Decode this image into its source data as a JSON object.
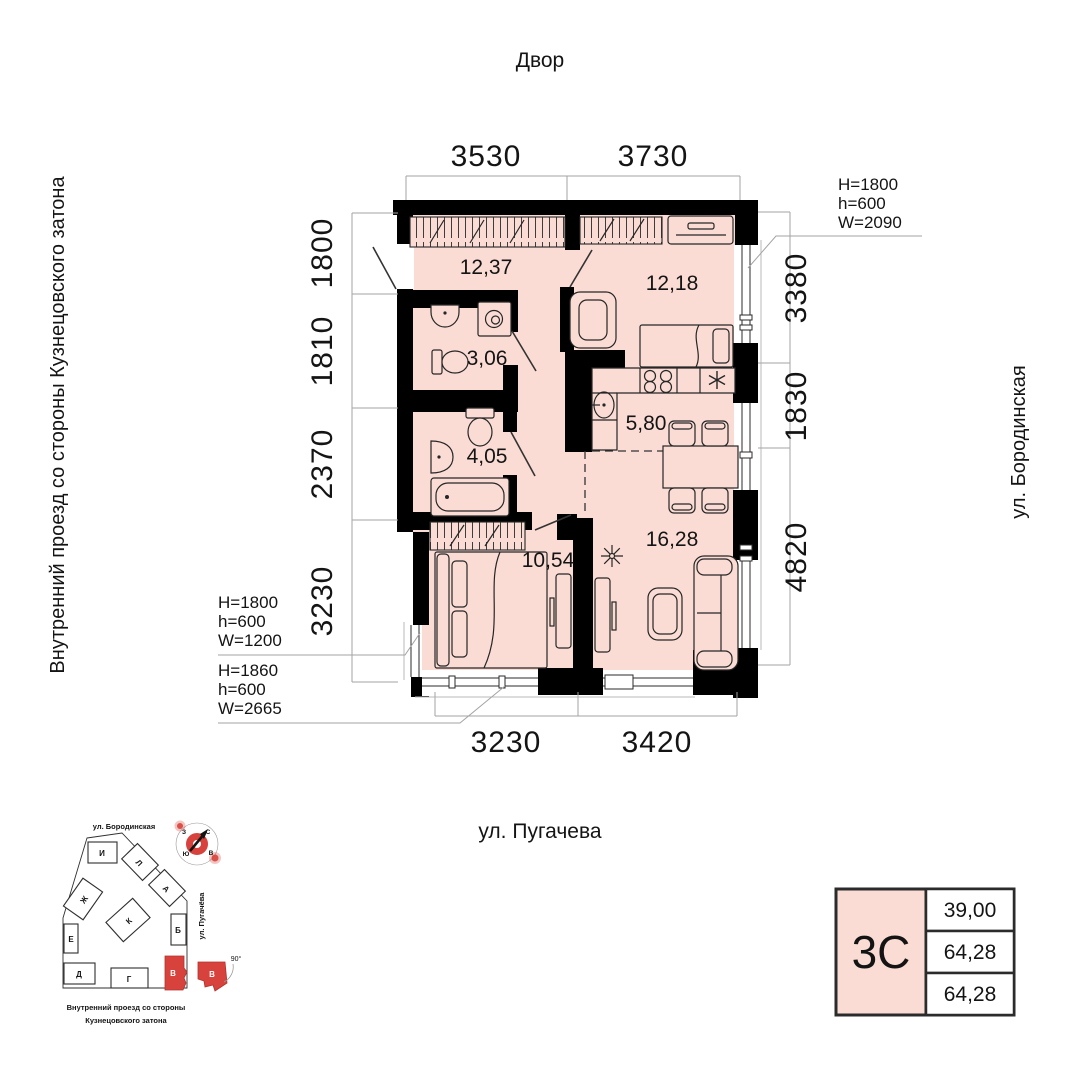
{
  "colors": {
    "room_fill": "#fadcd4",
    "wall": "#000000",
    "accent_red": "#d8423c",
    "dim_gray": "#a3a3a3",
    "text": "#141414"
  },
  "surroundings": {
    "top": "Двор",
    "bottom": "ул. Пугачева",
    "left": "Внутренний проезд со стороны Кузнецовского затона",
    "right": "ул. Бородинская"
  },
  "plan": {
    "rooms": [
      {
        "id": "hallway",
        "area": "12,37"
      },
      {
        "id": "bedroom-2",
        "area": "12,18"
      },
      {
        "id": "bathroom-small",
        "area": "3,06"
      },
      {
        "id": "bathroom-large",
        "area": "4,05"
      },
      {
        "id": "kitchen",
        "area": "5,80"
      },
      {
        "id": "bedroom-1",
        "area": "10,54"
      },
      {
        "id": "living-room",
        "area": "16,28"
      }
    ],
    "dims": {
      "top": [
        "3530",
        "3730"
      ],
      "bottom": [
        "3230",
        "3420"
      ],
      "left": [
        "1800",
        "1810",
        "2370",
        "3230"
      ],
      "right": [
        "3380",
        "1830",
        "4820"
      ]
    },
    "window_specs": [
      {
        "id": "right-window",
        "lines": [
          "H=1800",
          "h=600",
          "W=2090"
        ]
      },
      {
        "id": "left-window",
        "lines": [
          "H=1800",
          "h=600",
          "W=1200"
        ]
      },
      {
        "id": "bottom-window",
        "lines": [
          "H=1860",
          "h=600",
          "W=2665"
        ]
      }
    ]
  },
  "card": {
    "type": "3С",
    "rows": [
      "39,00",
      "64,28",
      "64,28"
    ]
  },
  "minimap": {
    "streets": {
      "top": "ул. Бородинская",
      "right": "ул. Пугачёва",
      "bottom_line1": "Внутренний проезд со стороны",
      "bottom_line2": "Кузнецовского затона"
    },
    "buildings": [
      {
        "label": "И"
      },
      {
        "label": "Л"
      },
      {
        "label": "А"
      },
      {
        "label": "Ж"
      },
      {
        "label": "К"
      },
      {
        "label": "Б"
      },
      {
        "label": "Е"
      },
      {
        "label": "Д"
      },
      {
        "label": "Г"
      },
      {
        "label": "В"
      },
      {
        "label": "В"
      }
    ],
    "angle_note": "90°",
    "compass": {
      "north": "С",
      "south": "Ю",
      "west": "З",
      "east": "В"
    }
  }
}
